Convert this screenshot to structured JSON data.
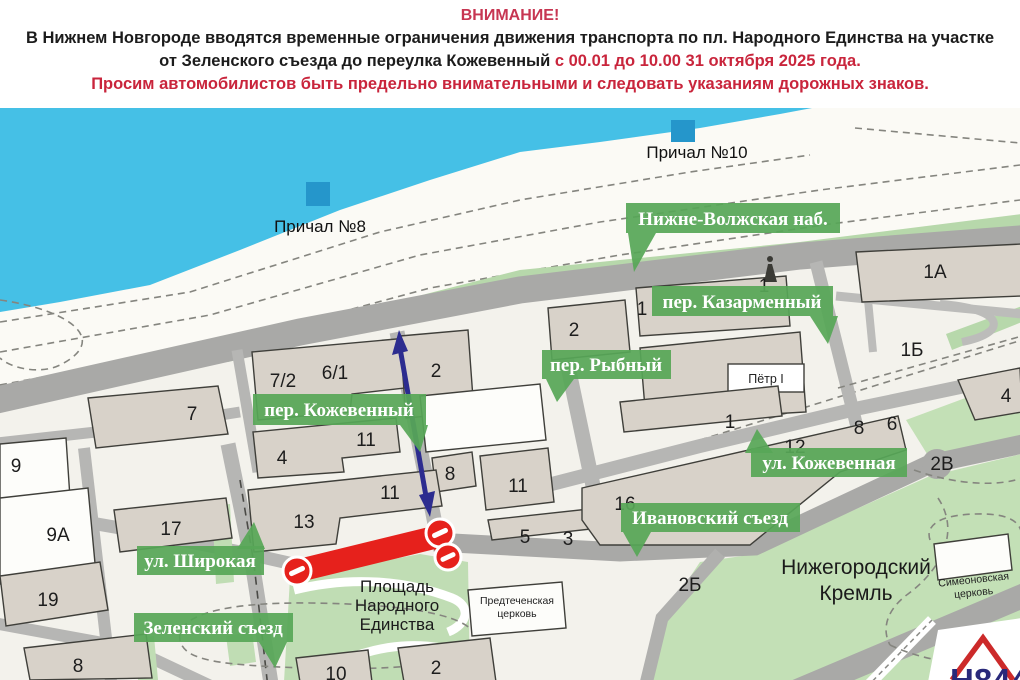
{
  "header": {
    "line1": "ВНИМАНИЕ!",
    "line2": "В Нижнем Новгороде вводятся временные ограничения движения транспорта по пл. Народного Единства на участке",
    "line3_black": "от Зеленского съезда до переулка Кожевенный",
    "line3_red": " с 00.01 до 10.00 31 октября 2025 года.",
    "line4": "Просим автомобилистов быть предельно внимательными и следовать указаниям дорожных знаков.",
    "colors": {
      "attention": "#c73652",
      "warning_red": "#c9253c",
      "text": "#1c1c1c"
    }
  },
  "map": {
    "piers": [
      {
        "label": "Причал №8"
      },
      {
        "label": "Причал №10"
      }
    ],
    "banners": [
      {
        "label": "Нижне-Волжская наб."
      },
      {
        "label": "пер. Казарменный"
      },
      {
        "label": "пер. Рыбный"
      },
      {
        "label": "пер. Кожевенный"
      },
      {
        "label": "ул. Кожевенная"
      },
      {
        "label": "Ивановский съезд"
      },
      {
        "label": "ул. Широкая"
      },
      {
        "label": "Зеленский съезд"
      }
    ],
    "numbers": [
      "7",
      "7/2",
      "6/1",
      "2",
      "2",
      "1",
      "1",
      "1А",
      "1Б",
      "9",
      "9А",
      "17",
      "19",
      "8",
      "4",
      "11",
      "11",
      "8",
      "11",
      "13",
      "5",
      "3",
      "16",
      "12",
      "8",
      "6",
      "4",
      "2В",
      "2Б",
      "2",
      "10",
      "1"
    ],
    "places": {
      "square": [
        "Площадь",
        "Народного",
        "Единства"
      ],
      "kremlin": [
        "Нижегородский",
        "Кремль"
      ],
      "church_predtech": [
        "Предтеченская",
        "церковь"
      ],
      "church_simeon": [
        "Симеоновская",
        "церковь"
      ],
      "monument": "Пётр I",
      "logo": "Н844"
    },
    "colors": {
      "water": "#45c0e6",
      "main_road": "#a9a9a7",
      "street": "#b6b6b4",
      "building": "#d8d2c9",
      "green": "#bfdcb2",
      "banner_green": "#57a757",
      "closure_red": "#e6211c",
      "arrow_blue": "#2c2c8f",
      "pier_blue": "#2596cb"
    }
  }
}
